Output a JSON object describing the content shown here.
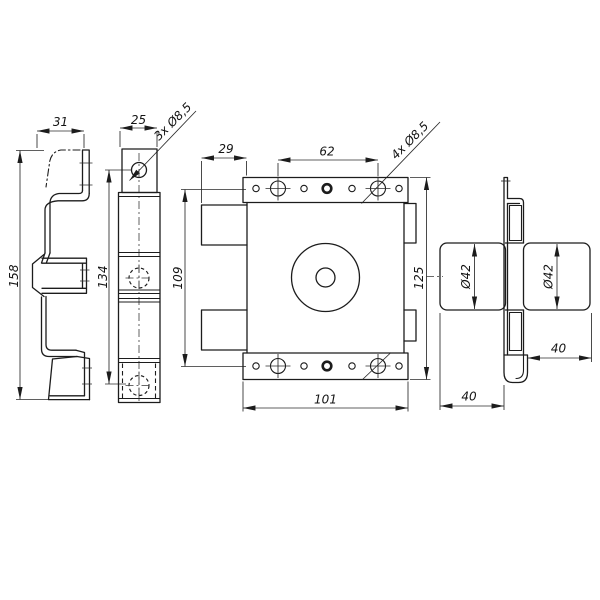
{
  "drawing": {
    "background": "#ffffff",
    "line_color": "#1c1c1c",
    "views": {
      "side_profile": {
        "dim_width": "31",
        "dim_height": "158"
      },
      "faceplate_front": {
        "dim_width": "25",
        "dim_hole_spacing": "134",
        "hole_note": "3x Ø8,5"
      },
      "lock_body_front": {
        "dim_tab_offset": "29",
        "dim_hole_spacing_h": "62",
        "hole_note": "4x Ø8,5",
        "dim_hole_spacing_v": "109",
        "dim_height": "125",
        "dim_width": "101"
      },
      "lock_body_side": {
        "dim_cylinder_dia_left": "Ø42",
        "dim_cylinder_dia_right": "Ø42",
        "dim_cylinder_length_right": "40",
        "dim_cylinder_length_left": "40"
      }
    }
  }
}
